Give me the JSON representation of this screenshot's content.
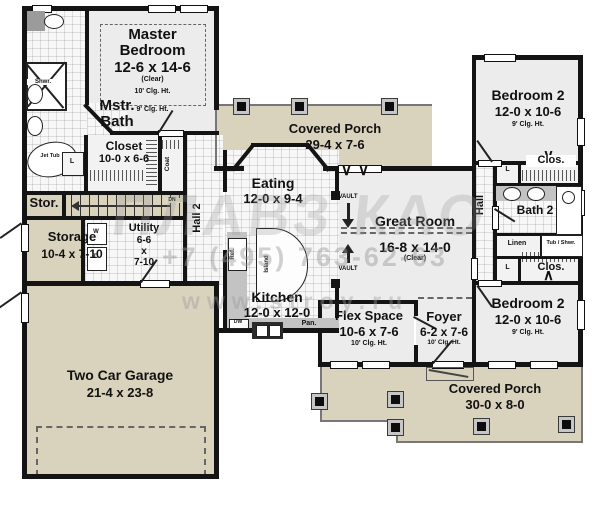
{
  "rooms": {
    "master_bedroom": {
      "name": "Master Bedroom",
      "dims": "12-6 x 14-6",
      "clear": "(Clear)",
      "clg10": "10' Clg. Ht.",
      "clg9": "9' Clg. Ht."
    },
    "mstr_bath": {
      "name": "Mstr. Bath"
    },
    "closet": {
      "name": "Closet",
      "dims": "10-0 x 6-6"
    },
    "coat": {
      "name": "Coat"
    },
    "stor": {
      "name": "Stor."
    },
    "storage": {
      "name": "Storage",
      "dims": "10-4 x 7-10"
    },
    "utility": {
      "name": "Utility",
      "d1": "6-6",
      "d2": "x",
      "d3": "7-10"
    },
    "hall2": {
      "name": "Hall 2"
    },
    "eating": {
      "name": "Eating",
      "dims": "12-0 x 9-4"
    },
    "kitchen": {
      "name": "Kitchen",
      "dims": "12-0 x 12-0"
    },
    "great_room": {
      "name": "Great Room",
      "dims": "16-8 x 14-0",
      "clear": "(Clear)"
    },
    "garage": {
      "name": "Two Car Garage",
      "dims": "21-4 x 23-8"
    },
    "flex": {
      "name": "Flex Space",
      "dims": "10-6 x 7-6",
      "clg": "10' Clg. Ht."
    },
    "foyer": {
      "name": "Foyer",
      "dims": "6-2 x 7-6",
      "clg": "10' Clg. Ht."
    },
    "bedroom2_top": {
      "name": "Bedroom 2",
      "dims": "12-0 x 10-6",
      "clg": "9' Clg. Ht."
    },
    "bedroom2_bottom": {
      "name": "Bedroom 2",
      "dims": "12-0 x 10-6",
      "clg": "9' Clg. Ht."
    },
    "bath2": {
      "name": "Bath 2"
    },
    "hall": {
      "name": "Hall"
    },
    "porch_top": {
      "name": "Covered Porch",
      "dims": "29-4 x 7-6"
    },
    "porch_bottom": {
      "name": "Covered Porch",
      "dims": "30-0 x 8-0"
    }
  },
  "fixtures": {
    "shwr": "Shwr.",
    "jet_tub": "Jet Tub",
    "l": "L",
    "w": "W",
    "d": "D",
    "dn": "DN",
    "ref": "Ref.",
    "island": "Island",
    "dw": "DW",
    "pan": "Pan.",
    "linen": "Linen",
    "tub_shwr": "Tub / Shwr.",
    "clos": "Clos.",
    "vault": "VAULT"
  },
  "watermark": {
    "logo_text": "ПЛАВЗ КАО",
    "phone": "+7 (495) 763-62-63",
    "site": "www.stroy.ru"
  },
  "colors": {
    "wall": "#141414",
    "porch": "#d9d2bd",
    "room": "#ececec"
  }
}
